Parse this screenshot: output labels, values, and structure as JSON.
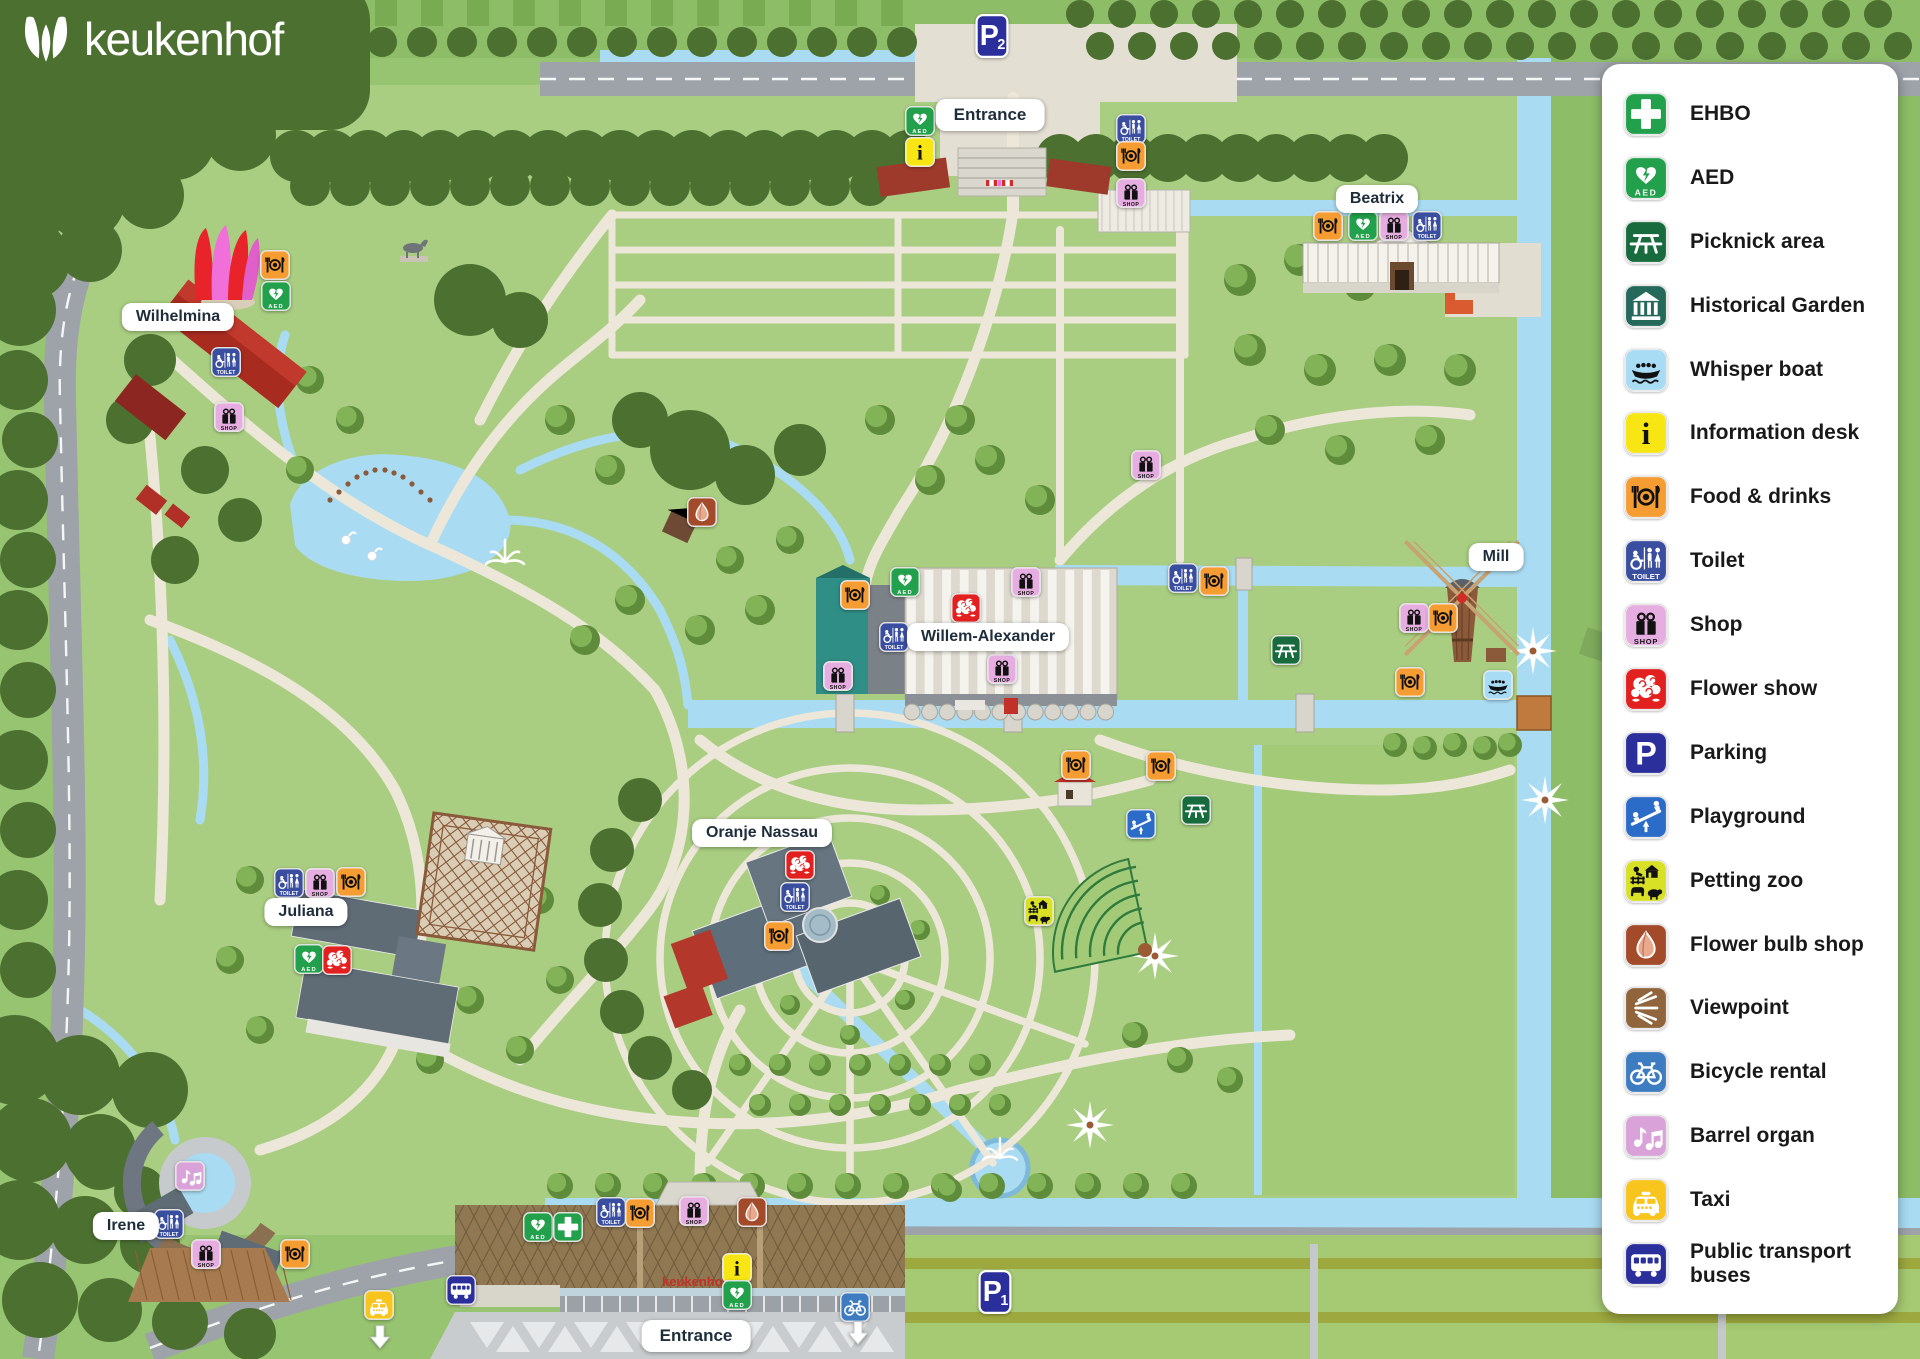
{
  "logo": {
    "text": "keukenhof"
  },
  "colors": {
    "grass": "#A9CE81",
    "grass_outer": "#8EBD67",
    "water": "#A9DBF2",
    "road": "#9DA3A8",
    "path": "#EDE7D9",
    "forest": "#4C7030",
    "panel": "#FFFFFF",
    "logo_green": "#4A6B2B",
    "label_text": "#1E2D3A"
  },
  "icons": {
    "aed_text": "AED",
    "toilet_text": "TOILET",
    "shop_text": "SHOP"
  },
  "legend": {
    "items": [
      {
        "id": "ehbo",
        "label": "EHBO",
        "color": "#22A04B"
      },
      {
        "id": "aed",
        "label": "AED",
        "color": "#22A04B"
      },
      {
        "id": "picnic",
        "label": "Picknick area",
        "color": "#176B3C"
      },
      {
        "id": "historical",
        "label": "Historical Garden",
        "color": "#25695B"
      },
      {
        "id": "whisperboat",
        "label": "Whisper boat",
        "color": "#A8DCF4"
      },
      {
        "id": "info",
        "label": "Information desk",
        "color": "#F8E614"
      },
      {
        "id": "food",
        "label": "Food & drinks",
        "color": "#F59C33"
      },
      {
        "id": "toilet",
        "label": "Toilet",
        "color": "#3A4E9F"
      },
      {
        "id": "shop",
        "label": "Shop",
        "color": "#E6AEE0"
      },
      {
        "id": "flowershow",
        "label": "Flower show",
        "color": "#E2201F"
      },
      {
        "id": "parking",
        "label": "Parking",
        "color": "#2A2F9C"
      },
      {
        "id": "playground",
        "label": "Playground",
        "color": "#2B6CC8"
      },
      {
        "id": "pettingzoo",
        "label": "Petting zoo",
        "color": "#D8E126"
      },
      {
        "id": "flowerbulb",
        "label": "Flower bulb shop",
        "color": "#A34A2B"
      },
      {
        "id": "viewpoint",
        "label": "Viewpoint",
        "color": "#90653B"
      },
      {
        "id": "bicycle",
        "label": "Bicycle rental",
        "color": "#3E7CC1"
      },
      {
        "id": "barrelorgan",
        "label": "Barrel organ",
        "color": "#D9A3D9"
      },
      {
        "id": "taxi",
        "label": "Taxi",
        "color": "#F7C51E"
      },
      {
        "id": "bus",
        "label": "Public transport buses",
        "color": "#2A2F9C"
      }
    ]
  },
  "map": {
    "building_label": "keukenhof",
    "labels": [
      {
        "text": "Entrance",
        "x": 990,
        "y": 115,
        "big": true
      },
      {
        "text": "Beatrix",
        "x": 1377,
        "y": 199,
        "big": false
      },
      {
        "text": "Wilhelmina",
        "x": 178,
        "y": 317,
        "big": false
      },
      {
        "text": "Mill",
        "x": 1496,
        "y": 557,
        "big": false
      },
      {
        "text": "Willem-Alexander",
        "x": 988,
        "y": 637,
        "big": false
      },
      {
        "text": "Oranje Nassau",
        "x": 762,
        "y": 833,
        "big": false
      },
      {
        "text": "Juliana",
        "x": 306,
        "y": 912,
        "big": false
      },
      {
        "text": "Irene",
        "x": 126,
        "y": 1226,
        "big": false
      },
      {
        "text": "Entrance",
        "x": 696,
        "y": 1336,
        "big": true
      }
    ],
    "parking_badges": [
      {
        "label": "P",
        "sub": "2",
        "x": 992,
        "y": 36
      },
      {
        "label": "P",
        "sub": "1",
        "x": 995,
        "y": 1292
      }
    ],
    "markers": [
      {
        "type": "aed",
        "x": 920,
        "y": 121
      },
      {
        "type": "info",
        "x": 920,
        "y": 152
      },
      {
        "type": "toilet",
        "x": 1131,
        "y": 129
      },
      {
        "type": "food",
        "x": 1131,
        "y": 156
      },
      {
        "type": "shop",
        "x": 1131,
        "y": 193
      },
      {
        "type": "food",
        "x": 1328,
        "y": 226
      },
      {
        "type": "aed",
        "x": 1363,
        "y": 226
      },
      {
        "type": "shop",
        "x": 1394,
        "y": 226
      },
      {
        "type": "toilet",
        "x": 1427,
        "y": 226
      },
      {
        "type": "food",
        "x": 275,
        "y": 265
      },
      {
        "type": "aed",
        "x": 276,
        "y": 296
      },
      {
        "type": "toilet",
        "x": 226,
        "y": 362
      },
      {
        "type": "shop",
        "x": 229,
        "y": 417
      },
      {
        "type": "flowerbulb",
        "x": 702,
        "y": 512
      },
      {
        "type": "aed",
        "x": 905,
        "y": 582
      },
      {
        "type": "food",
        "x": 855,
        "y": 595
      },
      {
        "type": "flowershow",
        "x": 966,
        "y": 608
      },
      {
        "type": "shop",
        "x": 1026,
        "y": 582
      },
      {
        "type": "toilet",
        "x": 894,
        "y": 637
      },
      {
        "type": "shop",
        "x": 838,
        "y": 676
      },
      {
        "type": "shop",
        "x": 1002,
        "y": 669
      },
      {
        "type": "shop",
        "x": 1146,
        "y": 465
      },
      {
        "type": "toilet",
        "x": 1183,
        "y": 578
      },
      {
        "type": "food",
        "x": 1214,
        "y": 581
      },
      {
        "type": "shop",
        "x": 1414,
        "y": 618
      },
      {
        "type": "food",
        "x": 1443,
        "y": 618
      },
      {
        "type": "food",
        "x": 1410,
        "y": 682
      },
      {
        "type": "whisperboat",
        "x": 1498,
        "y": 685
      },
      {
        "type": "picnic",
        "x": 1286,
        "y": 650
      },
      {
        "type": "food",
        "x": 1076,
        "y": 765
      },
      {
        "type": "food",
        "x": 1161,
        "y": 766
      },
      {
        "type": "playground",
        "x": 1141,
        "y": 824
      },
      {
        "type": "picnic",
        "x": 1196,
        "y": 810
      },
      {
        "type": "pettingzoo",
        "x": 1039,
        "y": 911
      },
      {
        "type": "flowershow",
        "x": 800,
        "y": 865
      },
      {
        "type": "toilet",
        "x": 795,
        "y": 897
      },
      {
        "type": "food",
        "x": 779,
        "y": 936
      },
      {
        "type": "toilet",
        "x": 289,
        "y": 883
      },
      {
        "type": "shop",
        "x": 320,
        "y": 883
      },
      {
        "type": "food",
        "x": 351,
        "y": 882
      },
      {
        "type": "aed",
        "x": 309,
        "y": 959
      },
      {
        "type": "flowershow",
        "x": 337,
        "y": 960
      },
      {
        "type": "barrelorgan",
        "x": 190,
        "y": 1176
      },
      {
        "type": "toilet",
        "x": 169,
        "y": 1224
      },
      {
        "type": "shop",
        "x": 206,
        "y": 1254
      },
      {
        "type": "food",
        "x": 295,
        "y": 1254
      },
      {
        "type": "taxi",
        "x": 379,
        "y": 1305
      },
      {
        "type": "bus",
        "x": 461,
        "y": 1290
      },
      {
        "type": "aed",
        "x": 538,
        "y": 1227
      },
      {
        "type": "ehbo",
        "x": 568,
        "y": 1227
      },
      {
        "type": "toilet",
        "x": 611,
        "y": 1212
      },
      {
        "type": "food",
        "x": 640,
        "y": 1213
      },
      {
        "type": "shop",
        "x": 694,
        "y": 1211
      },
      {
        "type": "flowerbulb",
        "x": 752,
        "y": 1212
      },
      {
        "type": "info",
        "x": 737,
        "y": 1268
      },
      {
        "type": "aed",
        "x": 737,
        "y": 1295
      },
      {
        "type": "bicycle",
        "x": 855,
        "y": 1307
      },
      {
        "type": "arrow",
        "x": 380,
        "y": 1337
      },
      {
        "type": "arrow",
        "x": 858,
        "y": 1333
      }
    ]
  }
}
